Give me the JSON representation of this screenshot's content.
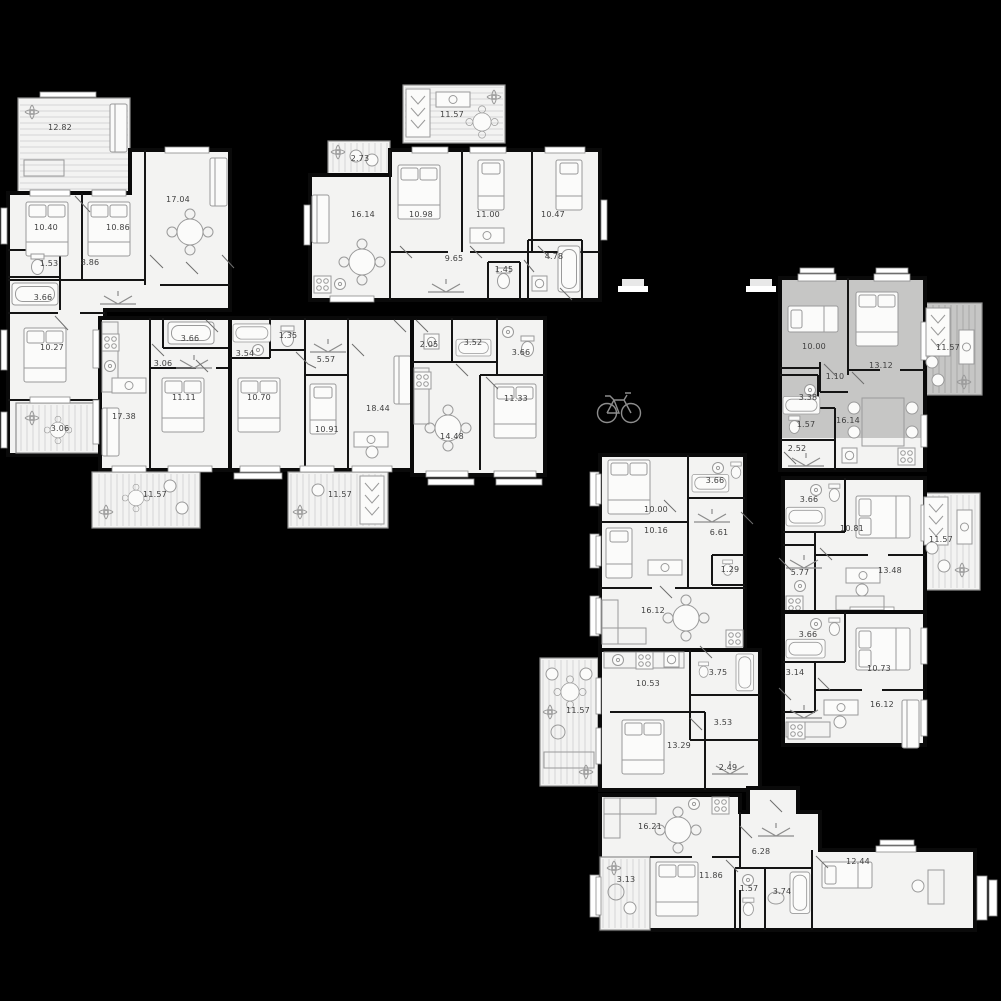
{
  "plan_title": "Residential floor plan",
  "colors": {
    "background": "#000000",
    "unit_fill": "#f3f3f2",
    "selected_unit_fill": "#c6c6c5",
    "wall": "#0a0a0a",
    "furniture_line": "#9a9a9a",
    "label_text": "#3f3f3f"
  },
  "corridor_icons": [
    {
      "name": "bicycle"
    }
  ],
  "units": [
    {
      "id": "tl",
      "name": "apartment-top-left",
      "highlighted": false,
      "rooms": [
        {
          "area": "12.82"
        },
        {
          "area": "10.40"
        },
        {
          "area": "10.86"
        },
        {
          "area": "17.04"
        },
        {
          "area": "1.53"
        },
        {
          "area": "8.86"
        },
        {
          "area": "3.66"
        },
        {
          "area": "10.27"
        },
        {
          "area": "3.06"
        }
      ]
    },
    {
      "id": "tm",
      "name": "apartment-top-middle",
      "highlighted": false,
      "rooms": [
        {
          "area": "11.57"
        },
        {
          "area": "2.73"
        },
        {
          "area": "16.14"
        },
        {
          "area": "10.98"
        },
        {
          "area": "11.00"
        },
        {
          "area": "10.47"
        },
        {
          "area": "9.65"
        },
        {
          "area": "1.45"
        },
        {
          "area": "4.78"
        }
      ]
    },
    {
      "id": "ml",
      "name": "apartment-middle-left",
      "highlighted": false,
      "rooms": [
        {
          "area": "3.66"
        },
        {
          "area": "3.06"
        },
        {
          "area": "17.38"
        },
        {
          "area": "11.11"
        },
        {
          "area": "11.57"
        }
      ]
    },
    {
      "id": "mm",
      "name": "apartment-middle-center",
      "highlighted": false,
      "rooms": [
        {
          "area": "1.35"
        },
        {
          "area": "3.54"
        },
        {
          "area": "5.57"
        },
        {
          "area": "10.70"
        },
        {
          "area": "10.91"
        },
        {
          "area": "18.44"
        },
        {
          "area": "11.57"
        }
      ]
    },
    {
      "id": "mr",
      "name": "apartment-middle-right",
      "highlighted": false,
      "rooms": [
        {
          "area": "2.05"
        },
        {
          "area": "3.52"
        },
        {
          "area": "3.66"
        },
        {
          "area": "11.33"
        },
        {
          "area": "14.48"
        }
      ]
    },
    {
      "id": "tr",
      "name": "apartment-top-right-selected",
      "highlighted": true,
      "rooms": [
        {
          "area": "10.00"
        },
        {
          "area": "13.12"
        },
        {
          "area": "1.10"
        },
        {
          "area": "3.38"
        },
        {
          "area": "1.57"
        },
        {
          "area": "16.14"
        },
        {
          "area": "2.52"
        },
        {
          "area": "11.57"
        }
      ]
    },
    {
      "id": "r1",
      "name": "apartment-right-upper",
      "highlighted": false,
      "rooms": [
        {
          "area": "3.66"
        },
        {
          "area": "10.81"
        },
        {
          "area": "5.77"
        },
        {
          "area": "13.48"
        },
        {
          "area": "11.57"
        }
      ]
    },
    {
      "id": "r2",
      "name": "apartment-right-lower",
      "highlighted": false,
      "rooms": [
        {
          "area": "3.66"
        },
        {
          "area": "10.73"
        },
        {
          "area": "3.14"
        },
        {
          "area": "16.12"
        }
      ]
    },
    {
      "id": "c1",
      "name": "apartment-center-upper",
      "highlighted": false,
      "rooms": [
        {
          "area": "10.00"
        },
        {
          "area": "3.66"
        },
        {
          "area": "10.16"
        },
        {
          "area": "6.61"
        },
        {
          "area": "1.29"
        },
        {
          "area": "16.12"
        }
      ]
    },
    {
      "id": "c2",
      "name": "apartment-center-lower",
      "highlighted": false,
      "rooms": [
        {
          "area": "10.53"
        },
        {
          "area": "3.75"
        },
        {
          "area": "3.53"
        },
        {
          "area": "13.29"
        },
        {
          "area": "2.49"
        },
        {
          "area": "11.57"
        }
      ]
    },
    {
      "id": "b",
      "name": "apartment-bottom",
      "highlighted": false,
      "rooms": [
        {
          "area": "16.21"
        },
        {
          "area": "6.28"
        },
        {
          "area": "12.44"
        },
        {
          "area": "3.13"
        },
        {
          "area": "11.86"
        },
        {
          "area": "1.57"
        },
        {
          "area": "3.74"
        }
      ]
    }
  ]
}
